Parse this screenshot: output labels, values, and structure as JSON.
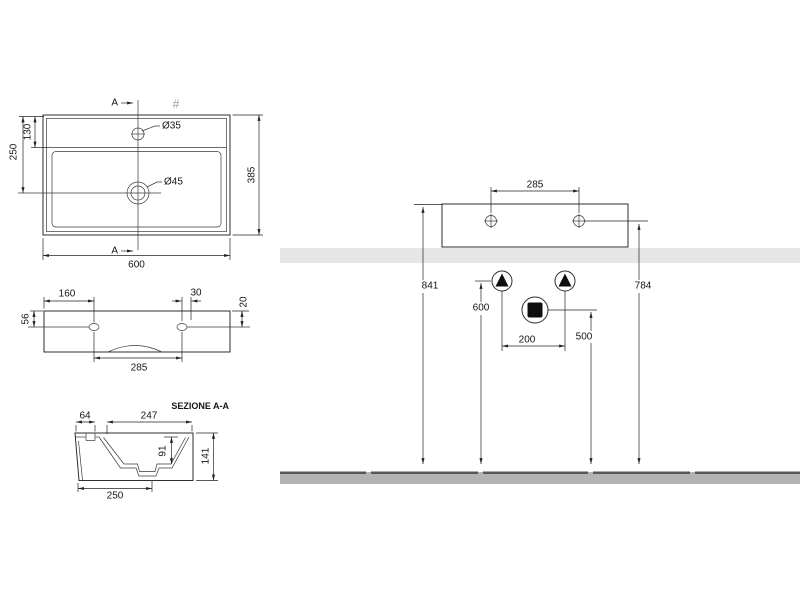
{
  "plan_view": {
    "section_marker_top": "A",
    "section_marker_bottom": "A",
    "hash_symbol": "#",
    "dim_width": "600",
    "dim_depth": "385",
    "dim_left_total": "250",
    "dim_left_upper": "130",
    "label_faucet_hole": "Ø35",
    "label_drain_hole": "Ø45"
  },
  "front_view": {
    "dim_left_to_hole": "160",
    "dim_hole_inset": "30",
    "dim_top_to_hole_right": "20",
    "dim_top_to_hole_left": "56",
    "dim_hole_spacing": "285"
  },
  "section_view": {
    "title": "SEZIONE A-A",
    "dim_ledge": "64",
    "dim_bowl_width": "247",
    "dim_bowl_depth": "91",
    "dim_height": "141",
    "dim_base_width": "250"
  },
  "installation_view": {
    "dim_fixing_holes": "285",
    "dim_rim_height": "841",
    "dim_fixing_height": "784",
    "dim_supply_height": "600",
    "dim_drain_height": "500",
    "dim_supply_spacing": "200"
  },
  "colors": {
    "wall_band": "#e6e6e6",
    "floor_fill": "#b3b3b3",
    "floor_edge": "#55575a"
  }
}
